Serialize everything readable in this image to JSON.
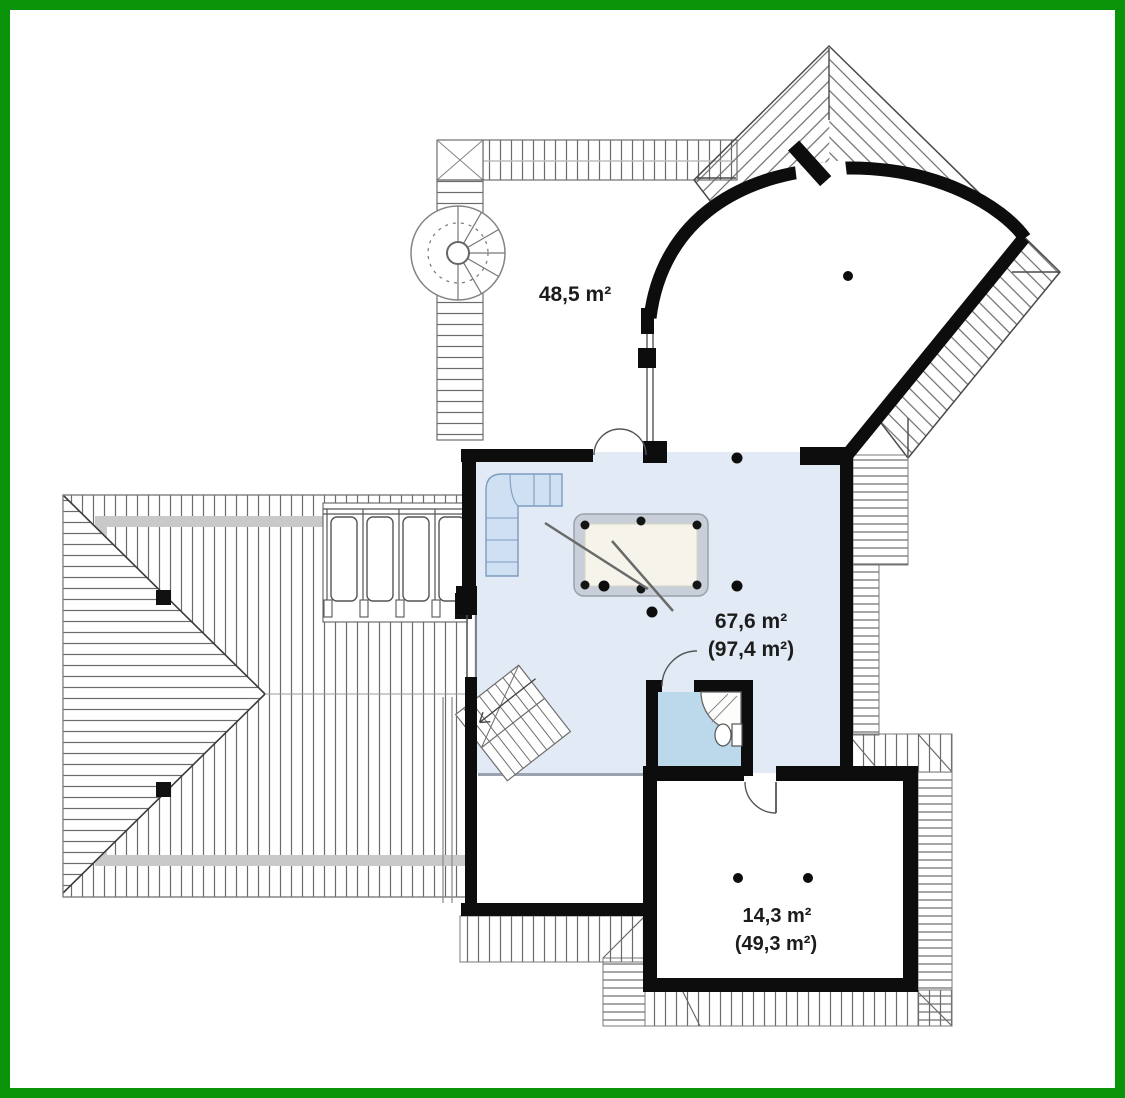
{
  "document": {
    "type": "attic-floor-plan",
    "frame_color": "#0a940a",
    "background": "#ffffff"
  },
  "colors": {
    "wall": "#0d0d0d",
    "main_floor": "#e2eaf5",
    "bath_floor": "#bcd9ec",
    "hatch_line": "#6b6b6b",
    "gray_band": "#c9c9c9",
    "furniture_blue": "#cfe0f2"
  },
  "rooms": [
    {
      "id": "attic-open-space",
      "area_label": "48,5 m²"
    },
    {
      "id": "main-room",
      "area_label": "67,6 m²",
      "area_label_secondary": "(97,4 m²)"
    },
    {
      "id": "bottom-room",
      "area_label": "14,3 m²",
      "area_label_secondary": "(49,3 m²)"
    }
  ],
  "icons": [
    "spiral-staircase-icon",
    "staircase-icon",
    "corner-sofa-icon",
    "billiard-table-icon",
    "shower-icon",
    "toilet-icon",
    "washbasin-icon",
    "door-arc-icon",
    "railing-icon",
    "chimney-icon",
    "column-dot-icon",
    "roof-hatch"
  ]
}
